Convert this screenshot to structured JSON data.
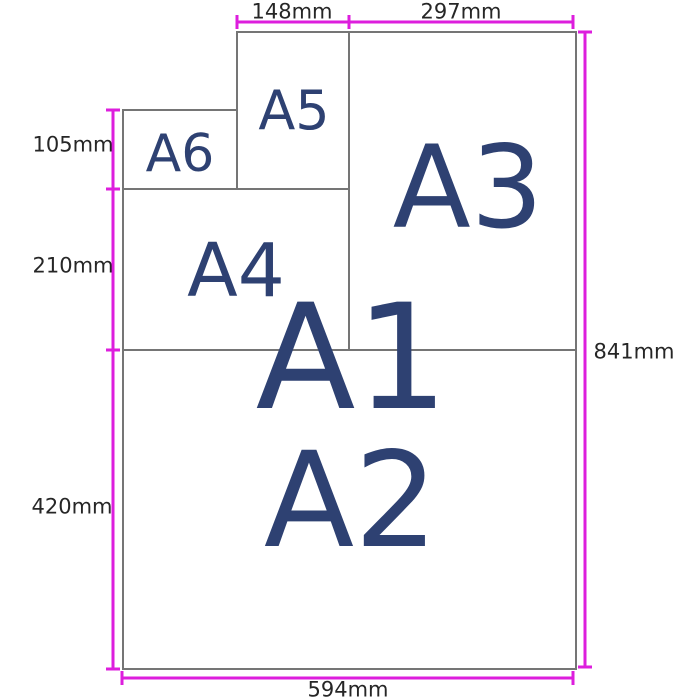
{
  "colors": {
    "dimension_line": "#DD1EDD",
    "paper_border": "#757575",
    "paper_label_text": "#2E4172",
    "dimension_text": "#262626",
    "background": "#FFFFFF"
  },
  "papers": {
    "a1": {
      "label": "A1"
    },
    "a2": {
      "label": "A2"
    },
    "a3": {
      "label": "A3"
    },
    "a4": {
      "label": "A4"
    },
    "a5": {
      "label": "A5"
    },
    "a6": {
      "label": "A6"
    }
  },
  "dimensions": {
    "top_width_a5": "148mm",
    "top_width_a3": "297mm",
    "left_height_a6": "105mm",
    "left_height_a4": "210mm",
    "left_height_a2": "420mm",
    "right_height_a1": "841mm",
    "bottom_width_a1": "594mm"
  }
}
